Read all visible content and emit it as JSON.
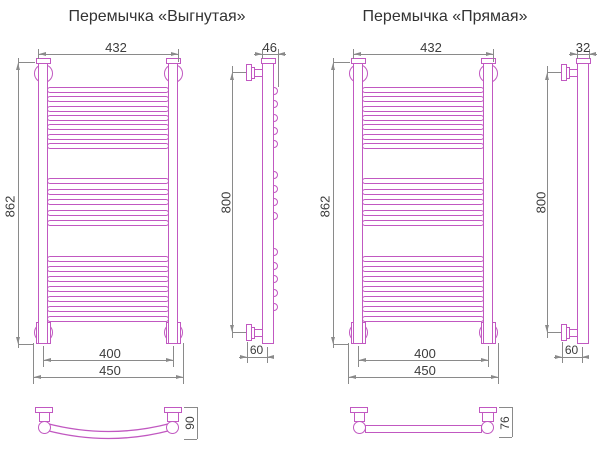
{
  "titles": {
    "curved": "Перемычка «Выгнутая»",
    "straight": "Перемычка «Прямая»"
  },
  "dimensions": {
    "curved": {
      "top_width": "432",
      "height": "862",
      "inner_width": "400",
      "outer_width": "450",
      "side_depth": "46",
      "side_height": "800",
      "wall_distance": "60",
      "crossbar_depth": "90"
    },
    "straight": {
      "top_width": "432",
      "height": "862",
      "inner_width": "400",
      "outer_width": "450",
      "side_depth": "32",
      "side_height": "800",
      "wall_distance": "60",
      "crossbar_depth": "76"
    }
  },
  "structure": {
    "rung_groups": [
      7,
      5,
      7
    ],
    "side_bump_groups": [
      5,
      4,
      5
    ]
  },
  "colors": {
    "drawing_line": "#c158c1",
    "dimension_line": "#8a8a8a",
    "label_text": "#3c3c3c",
    "background": "#ffffff"
  }
}
